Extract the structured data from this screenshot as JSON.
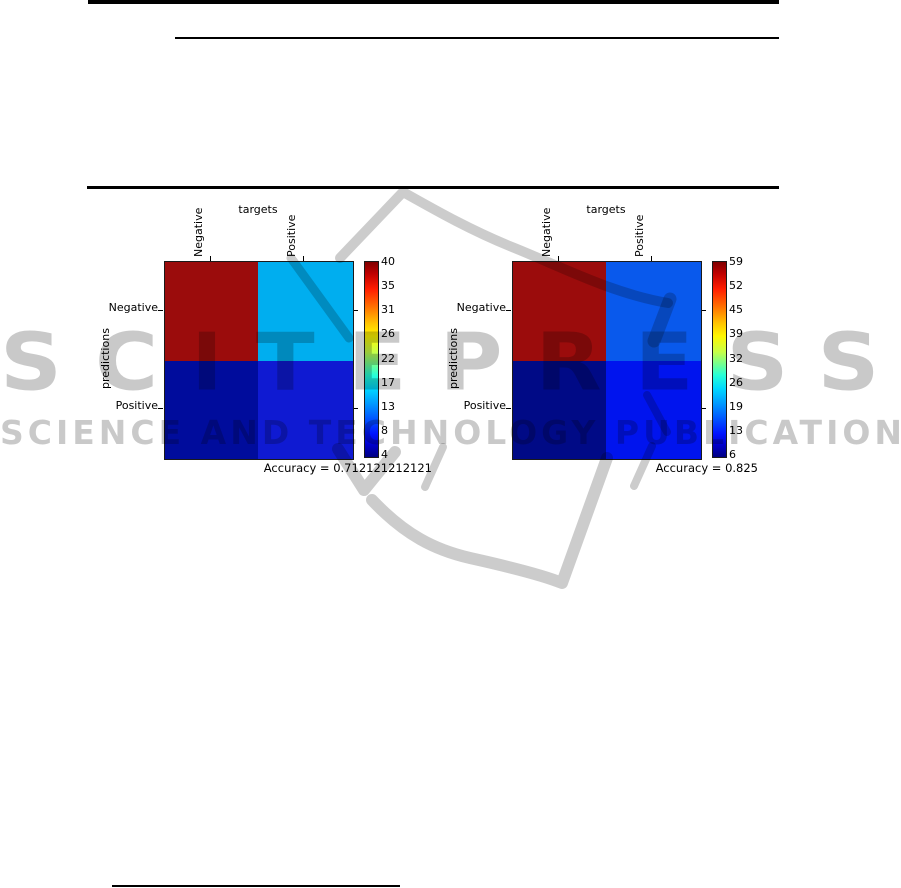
{
  "watermark": {
    "title": "SCITEPRESS",
    "subtitle": "SCIENCE AND TECHNOLOGY PUBLICATIONS",
    "tint_on_white": "#c9c9c9"
  },
  "figures": [
    {
      "side": "left",
      "top_axis_label": "targets",
      "left_axis_label": "predictions",
      "col_labels": [
        "Negative",
        "Positive"
      ],
      "row_labels": [
        "Negative",
        "Positive"
      ],
      "cells": [
        {
          "position": "top-left",
          "target": "Negative",
          "prediction": "Negative",
          "color": "#9b0c0c"
        },
        {
          "position": "top-right",
          "target": "Positive",
          "prediction": "Negative",
          "color": "#00aeef"
        },
        {
          "position": "bottom-left",
          "target": "Negative",
          "prediction": "Positive",
          "color": "#000c9c"
        },
        {
          "position": "bottom-right",
          "target": "Positive",
          "prediction": "Positive",
          "color": "#0f1ad2"
        }
      ],
      "colorbar": {
        "ticks": [
          "40",
          "35",
          "31",
          "26",
          "22",
          "17",
          "13",
          "8",
          "4"
        ]
      },
      "caption": "Accuracy = 0.712121212121"
    },
    {
      "side": "right",
      "top_axis_label": "targets",
      "left_axis_label": "predictions",
      "col_labels": [
        "Negative",
        "Positive"
      ],
      "row_labels": [
        "Negative",
        "Positive"
      ],
      "cells": [
        {
          "position": "top-left",
          "target": "Negative",
          "prediction": "Negative",
          "color": "#9b0c0c"
        },
        {
          "position": "top-right",
          "target": "Positive",
          "prediction": "Negative",
          "color": "#0959ec"
        },
        {
          "position": "bottom-left",
          "target": "Negative",
          "prediction": "Positive",
          "color": "#000a86"
        },
        {
          "position": "bottom-right",
          "target": "Positive",
          "prediction": "Positive",
          "color": "#0014ee"
        }
      ],
      "colorbar": {
        "ticks": [
          "59",
          "52",
          "45",
          "39",
          "32",
          "26",
          "19",
          "13",
          "6"
        ]
      },
      "caption": "Accuracy = 0.825"
    }
  ],
  "chart_data": [
    {
      "type": "heatmap",
      "x_categories": [
        "Negative",
        "Positive"
      ],
      "y_categories": [
        "Negative",
        "Positive"
      ],
      "xlabel": "targets",
      "ylabel": "predictions",
      "values": [
        [
          40,
          15
        ],
        [
          4,
          7
        ]
      ],
      "value_range": [
        4,
        40
      ],
      "colormap": "jet",
      "colorbar_ticks": [
        40,
        35,
        31,
        26,
        22,
        17,
        13,
        8,
        4
      ],
      "annotation": "Accuracy = 0.712121212121",
      "legend_position": "right-colorbar",
      "grid": false
    },
    {
      "type": "heatmap",
      "x_categories": [
        "Negative",
        "Positive"
      ],
      "y_categories": [
        "Negative",
        "Positive"
      ],
      "xlabel": "targets",
      "ylabel": "predictions",
      "values": [
        [
          59,
          13
        ],
        [
          6,
          10
        ]
      ],
      "value_range": [
        6,
        59
      ],
      "colormap": "jet",
      "colorbar_ticks": [
        59,
        52,
        45,
        39,
        32,
        26,
        19,
        13,
        6
      ],
      "annotation": "Accuracy = 0.825",
      "legend_position": "right-colorbar",
      "grid": false
    }
  ]
}
